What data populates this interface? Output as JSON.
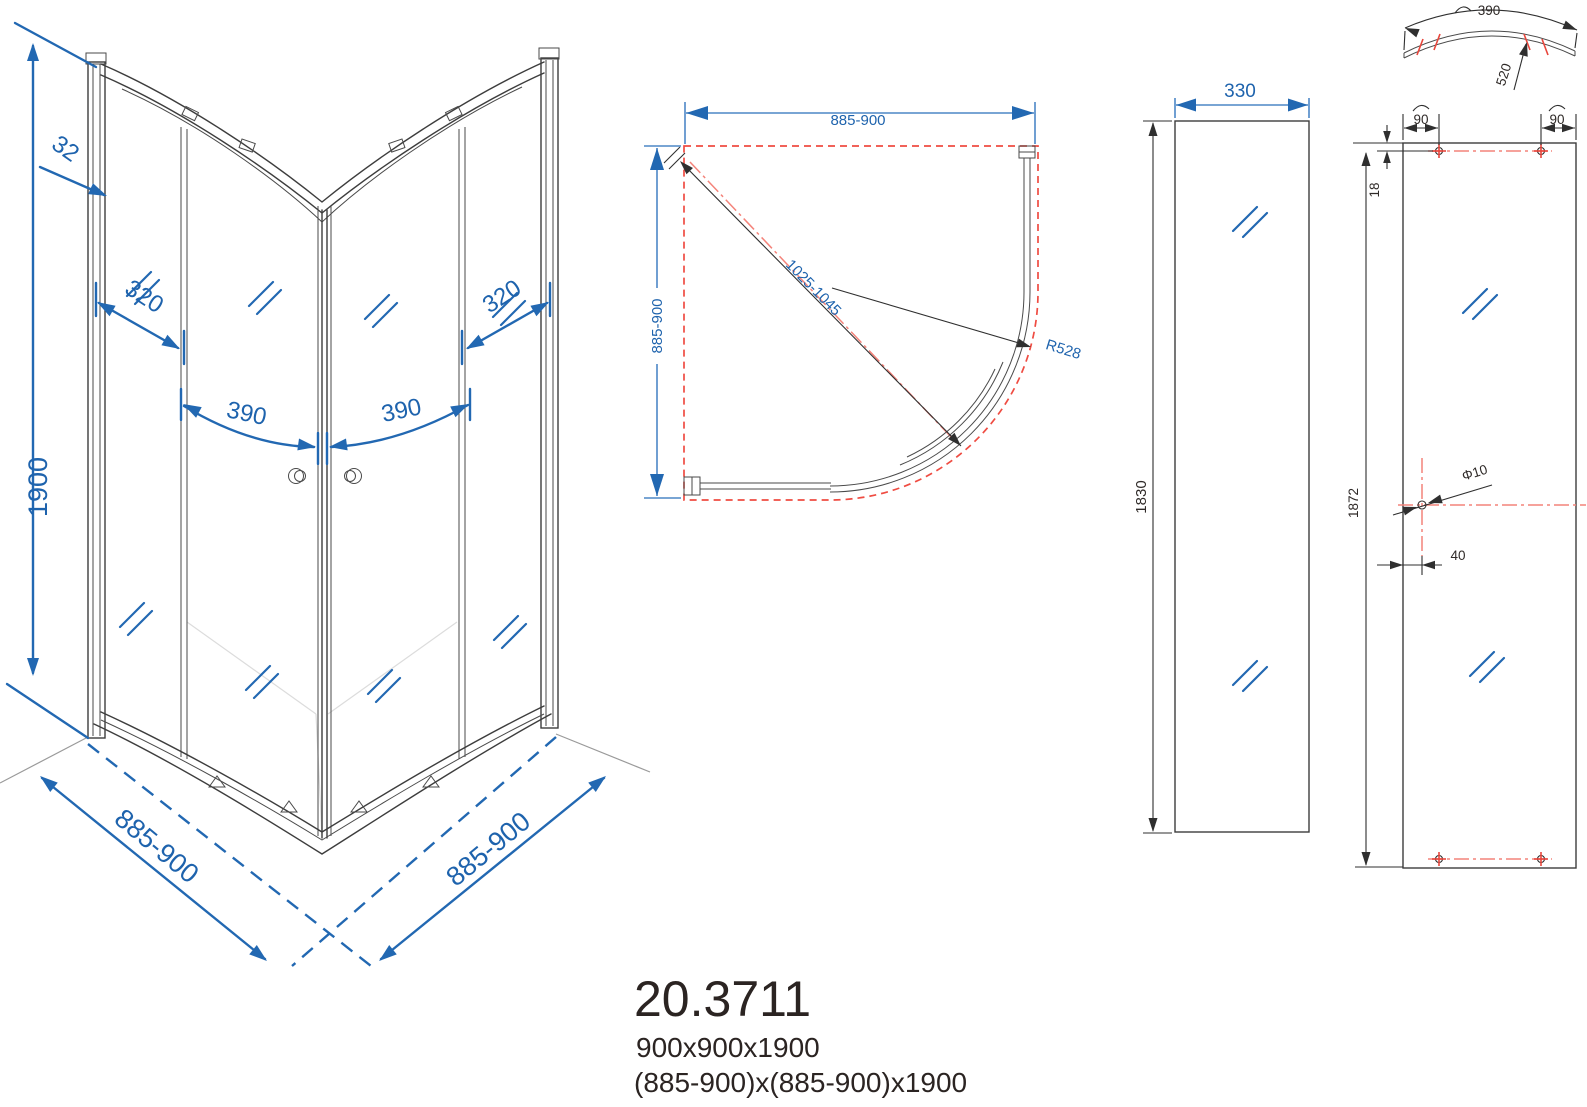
{
  "product": {
    "code": "20.3711",
    "size_nominal": "900x900x1900",
    "size_range": "(885-900)x(885-900)x1900"
  },
  "colors": {
    "dimension_blue": "#2268b2",
    "line_dark": "#3d3d3d",
    "marking_red": "#ef4c42",
    "centerline_red": "#f4837a"
  },
  "views": {
    "front_elevation": {
      "dims": {
        "height": "1900",
        "frame": "32",
        "fixed_left": "320",
        "fixed_right": "320",
        "door_left": "390",
        "door_right": "390",
        "width_left": "885-900",
        "width_right": "885-900"
      }
    },
    "plan": {
      "dims": {
        "width": "885-900",
        "depth": "885-900",
        "diagonal": "1025-1045",
        "radius": "R528"
      }
    },
    "side_panel": {
      "dims": {
        "width": "330",
        "height": "1830"
      }
    },
    "door_glass": {
      "dims": {
        "arc_width": "390",
        "arc_length": "520",
        "hole_left": "90",
        "hole_right": "90",
        "top_offset": "18",
        "height": "1872",
        "hole_diameter": "Φ10",
        "side_offset": "40"
      }
    }
  }
}
